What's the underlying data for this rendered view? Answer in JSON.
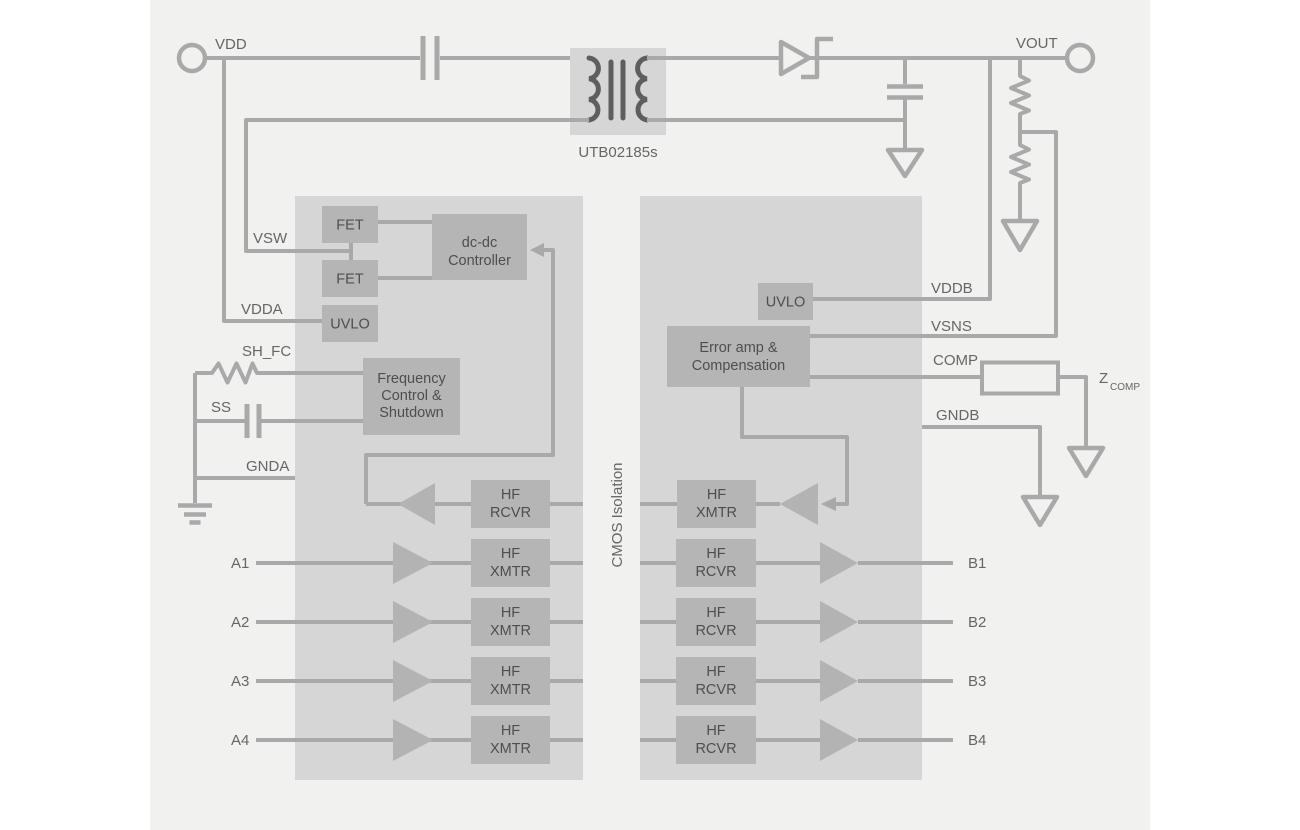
{
  "colors": {
    "canvas": "#ffffff",
    "panel": "#f1f1f0",
    "chip_block": "#d6d6d6",
    "inner_box": "#b5b5b5",
    "wire": "#a9a9a9",
    "transformer_winding": "#5e5e5e",
    "label_text": "#666666",
    "box_text": "#4e4e4e"
  },
  "terminals": {
    "vdd": "VDD",
    "vout": "VOUT"
  },
  "transformer": {
    "part_number": "UTB02185s"
  },
  "isolation": {
    "label": "CMOS Isolation"
  },
  "left_chip": {
    "fet_top": "FET",
    "fet_bottom": "FET",
    "controller": {
      "line1": "dc-dc",
      "line2": "Controller"
    },
    "uvlo": "UVLO",
    "freq_ctrl": {
      "line1": "Frequency",
      "line2": "Control &",
      "line3": "Shutdown"
    },
    "hf_rcvr": {
      "line1": "HF",
      "line2": "RCVR"
    },
    "hf_xmtr": {
      "line1": "HF",
      "line2": "XMTR"
    }
  },
  "right_chip": {
    "uvlo": "UVLO",
    "error_amp": {
      "line1": "Error amp &",
      "line2": "Compensation"
    },
    "hf_xmtr": {
      "line1": "HF",
      "line2": "XMTR"
    },
    "hf_rcvr": {
      "line1": "HF",
      "line2": "RCVR"
    }
  },
  "pins": {
    "vsw": "VSW",
    "vdda": "VDDA",
    "sh_fc": "SH_FC",
    "ss": "SS",
    "gnda": "GNDA",
    "vddb": "VDDB",
    "vsns": "VSNS",
    "comp": "COMP",
    "gndb": "GNDB"
  },
  "channels": {
    "a": [
      "A1",
      "A2",
      "A3",
      "A4"
    ],
    "b": [
      "B1",
      "B2",
      "B3",
      "B4"
    ]
  },
  "zcomp": {
    "symbol": "Z",
    "subscript": "COMP"
  }
}
